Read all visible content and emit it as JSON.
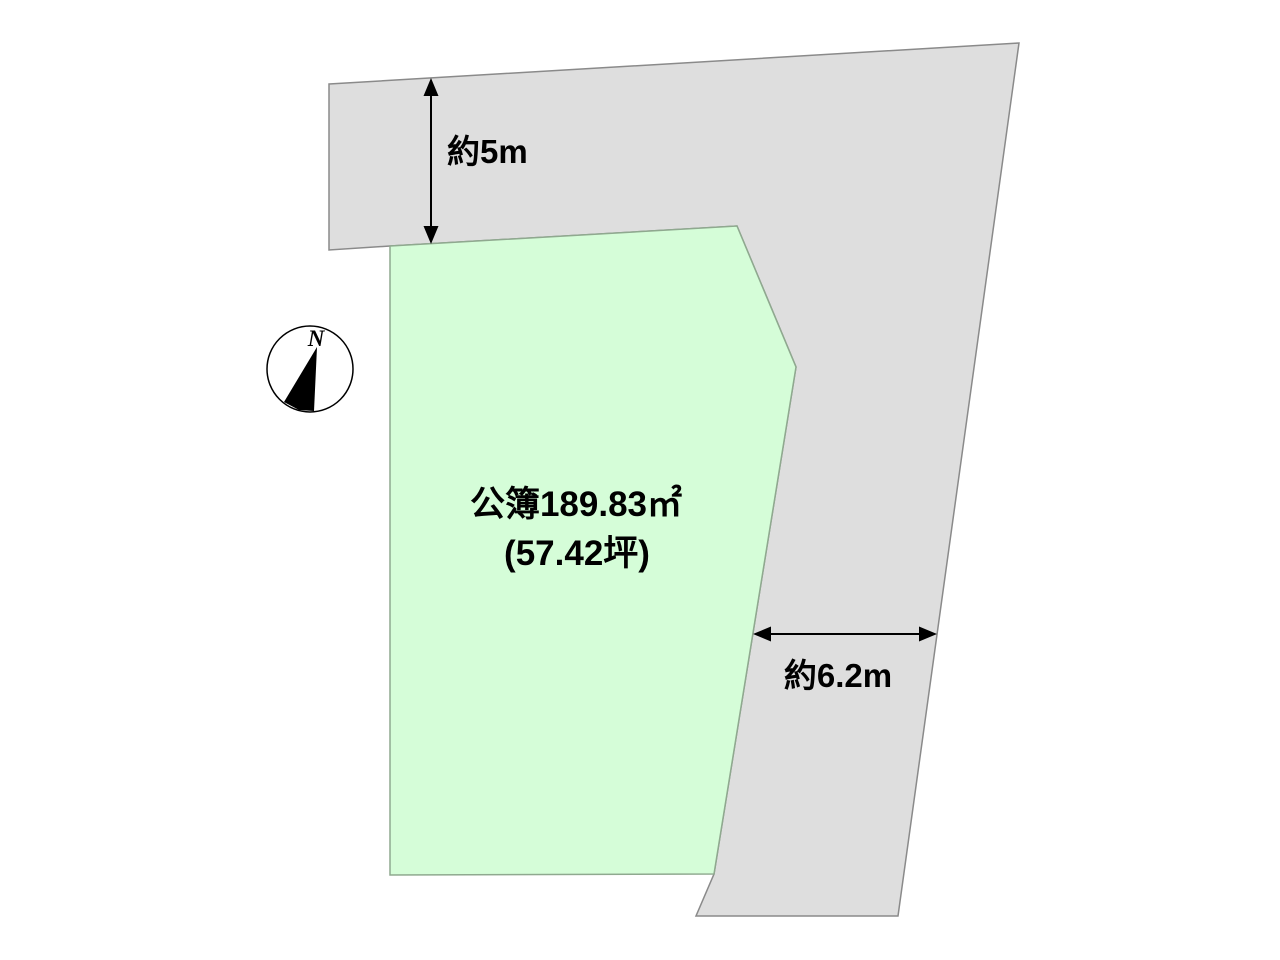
{
  "diagram": {
    "kind": "land-plot-layout",
    "plot": {
      "area_label": "公簿189.83㎡",
      "tsubo_label": "(57.42坪)"
    },
    "dimensions": {
      "top_depth": "約5m",
      "right_width": "約6.2m"
    },
    "compass": {
      "north_label": "N"
    },
    "colors": {
      "background": "#ffffff",
      "road_fill": "#dedede",
      "road_stroke": "#8a8a8a",
      "plot_fill": "#d5fdd8",
      "plot_stroke": "#8fa98f",
      "arrow": "#000000",
      "text": "#000000",
      "compass_fill": "#ffffff",
      "compass_stroke": "#000000"
    }
  }
}
